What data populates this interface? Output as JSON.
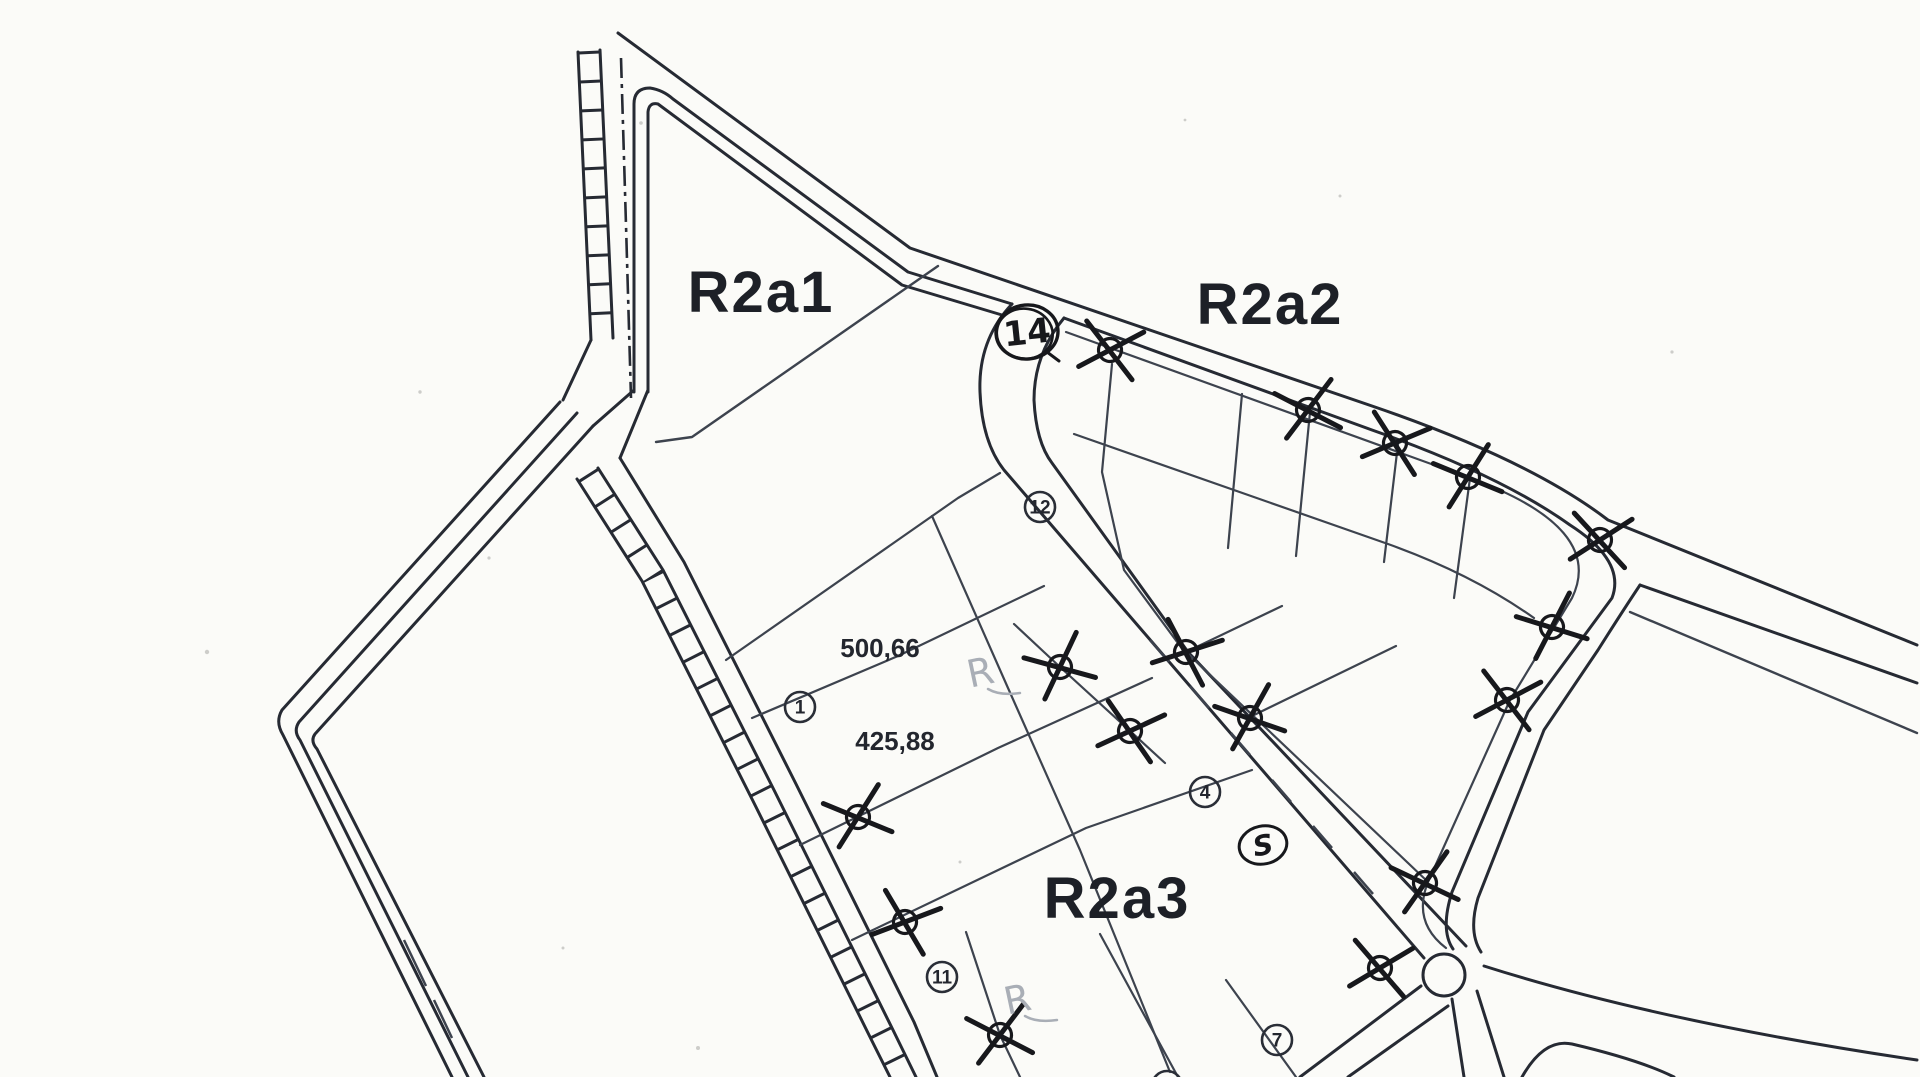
{
  "map": {
    "zone_labels": [
      {
        "text": "R2a1",
        "x": 761,
        "y": 312
      },
      {
        "text": "R2a2",
        "x": 1270,
        "y": 324
      },
      {
        "text": "R2a3",
        "x": 1117,
        "y": 918
      }
    ],
    "area_measurements": [
      {
        "text": "500,66",
        "x": 880,
        "y": 657
      },
      {
        "text": "425,88",
        "x": 895,
        "y": 750
      }
    ],
    "plot_markers": [
      {
        "label": "1",
        "x": 800,
        "y": 707
      },
      {
        "label": "4",
        "x": 1205,
        "y": 792
      },
      {
        "label": "7",
        "x": 1277,
        "y": 1040
      },
      {
        "label": "11",
        "x": 942,
        "y": 977
      },
      {
        "label": "12",
        "x": 1040,
        "y": 507
      }
    ],
    "crossed_markers": [
      {
        "x": 1110,
        "y": 350,
        "rot": 15
      },
      {
        "x": 1308,
        "y": 410,
        "rot": -10
      },
      {
        "x": 1395,
        "y": 443,
        "rot": 20
      },
      {
        "x": 1468,
        "y": 477,
        "rot": -15
      },
      {
        "x": 1600,
        "y": 540,
        "rot": 10
      },
      {
        "x": 1552,
        "y": 627,
        "rot": -20
      },
      {
        "x": 1507,
        "y": 700,
        "rot": 15
      },
      {
        "x": 1425,
        "y": 883,
        "rot": -12
      },
      {
        "x": 1186,
        "y": 652,
        "rot": 25
      },
      {
        "x": 1250,
        "y": 718,
        "rot": -18
      },
      {
        "x": 1380,
        "y": 968,
        "rot": 12
      },
      {
        "x": 1060,
        "y": 667,
        "rot": -22
      },
      {
        "x": 1130,
        "y": 731,
        "rot": 18
      },
      {
        "x": 858,
        "y": 817,
        "rot": -15
      },
      {
        "x": 905,
        "y": 922,
        "rot": 22
      },
      {
        "x": 1000,
        "y": 1035,
        "rot": -10
      }
    ],
    "handwritten": {
      "circled_number": {
        "text": "14",
        "x": 1027,
        "y": 332
      },
      "circled_letter": {
        "text": "S",
        "x": 1263,
        "y": 845
      },
      "pencil_marks": [
        {
          "text": "R",
          "x": 983,
          "y": 685
        },
        {
          "text": "R",
          "x": 1020,
          "y": 1012
        }
      ]
    },
    "colors": {
      "paper": "#fbfbf8",
      "ink": "#262a33",
      "ink_light": "#3d434e",
      "pen": "#17181c",
      "pencil": "#a9aeb6"
    }
  }
}
